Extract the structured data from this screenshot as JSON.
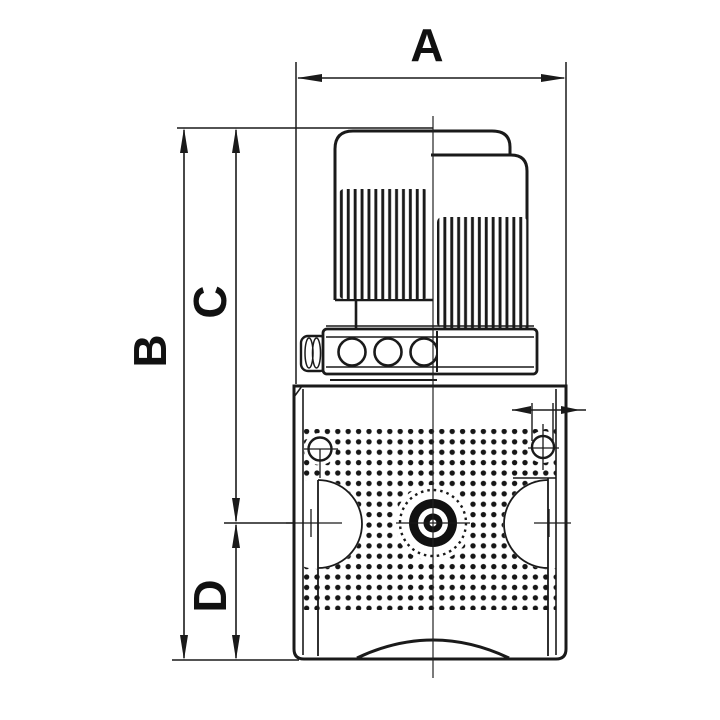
{
  "diagram": {
    "type": "dimensioned technical drawing",
    "labels": {
      "a": "A",
      "b": "B",
      "c": "C",
      "d": "D"
    },
    "colors": {
      "line": "#1a1a1a",
      "label": "#111111",
      "background": "#ffffff",
      "stipple": "#161616"
    }
  }
}
